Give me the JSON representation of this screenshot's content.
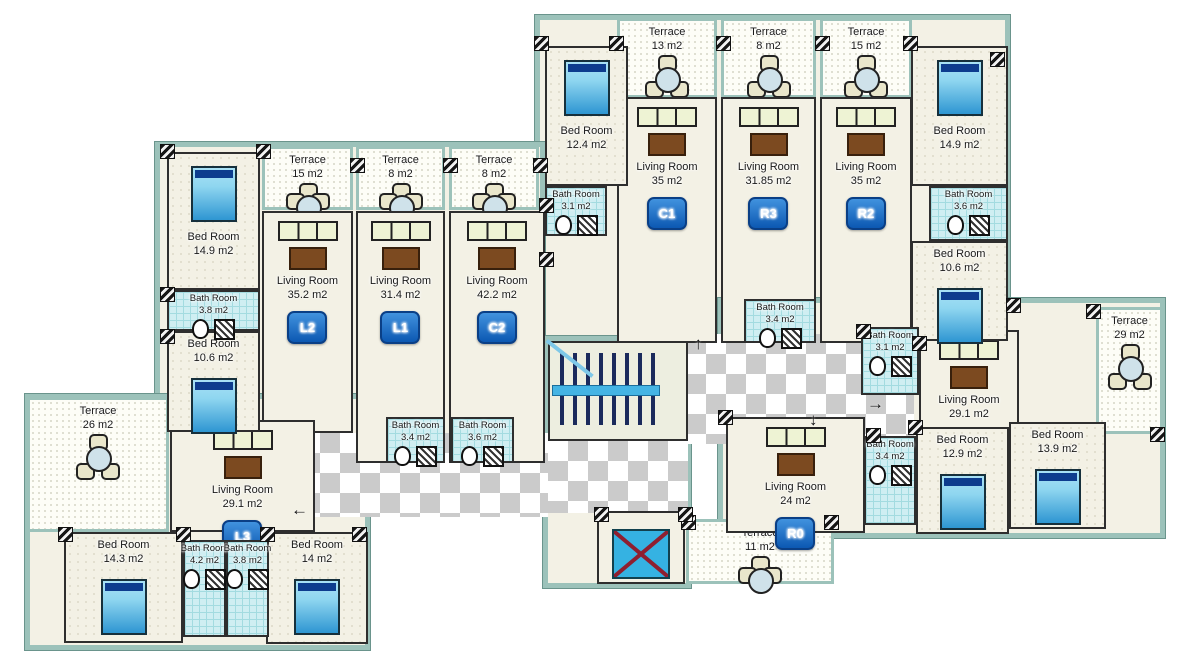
{
  "plan": {
    "colors": {
      "wall_teal": "#9cc2ba",
      "floor_cream": "#f3f1e5",
      "bath_cyan": "#cfeef2",
      "bed_blue": "#2e96d2",
      "badge_blue": "#0c58b2",
      "corridor_checker_gray": "#cbcbcb",
      "elevator_blue": "#35b2e2",
      "elevator_cross_red": "#8e1f30",
      "stairs_navy": "#1b2a5c"
    },
    "shells": [
      {
        "x": 535,
        "y": 15,
        "w": 475,
        "h": 330
      },
      {
        "x": 155,
        "y": 142,
        "w": 390,
        "h": 322
      },
      {
        "x": 25,
        "y": 394,
        "w": 345,
        "h": 256
      },
      {
        "x": 718,
        "y": 298,
        "w": 447,
        "h": 240
      },
      {
        "x": 543,
        "y": 336,
        "w": 148,
        "h": 252
      }
    ],
    "corridors": [
      {
        "x": 300,
        "y": 433,
        "w": 248,
        "h": 84
      },
      {
        "x": 666,
        "y": 334,
        "w": 248,
        "h": 110
      },
      {
        "x": 548,
        "y": 441,
        "w": 140,
        "h": 72
      }
    ],
    "rooms": [
      {
        "type": "terrace",
        "label": "Terrace",
        "area": "13 m2",
        "x": 617,
        "y": 18,
        "w": 100,
        "h": 80
      },
      {
        "type": "terrace",
        "label": "Terrace",
        "area": "8 m2",
        "x": 721,
        "y": 18,
        "w": 95,
        "h": 80
      },
      {
        "type": "terrace",
        "label": "Terrace",
        "area": "15 m2",
        "x": 820,
        "y": 18,
        "w": 92,
        "h": 80
      },
      {
        "type": "terrace",
        "label": "Terrace",
        "area": "15 m2",
        "x": 262,
        "y": 146,
        "w": 91,
        "h": 64
      },
      {
        "type": "terrace",
        "label": "Terrace",
        "area": "8 m2",
        "x": 356,
        "y": 146,
        "w": 89,
        "h": 64
      },
      {
        "type": "terrace",
        "label": "Terrace",
        "area": "8 m2",
        "x": 449,
        "y": 146,
        "w": 90,
        "h": 64
      },
      {
        "type": "terrace",
        "label": "Terrace",
        "area": "26 m2",
        "x": 27,
        "y": 397,
        "w": 142,
        "h": 135
      },
      {
        "type": "terrace",
        "label": "Terrace",
        "area": "29 m2",
        "x": 1096,
        "y": 307,
        "w": 67,
        "h": 127
      },
      {
        "type": "terrace",
        "label": "Terrace",
        "area": "11 m2",
        "x": 686,
        "y": 519,
        "w": 148,
        "h": 65
      },
      {
        "type": "living",
        "label": "Living Room",
        "area": "35 m2",
        "badge": "C1",
        "x": 617,
        "y": 97,
        "w": 100,
        "h": 246
      },
      {
        "type": "living",
        "label": "Living Room",
        "area": "31.85 m2",
        "badge": "R3",
        "x": 721,
        "y": 97,
        "w": 95,
        "h": 246
      },
      {
        "type": "living",
        "label": "Living Room",
        "area": "35 m2",
        "badge": "R2",
        "x": 820,
        "y": 97,
        "w": 92,
        "h": 246
      },
      {
        "type": "living",
        "label": "Living Room",
        "area": "35.2 m2",
        "badge": "L2",
        "x": 262,
        "y": 211,
        "w": 91,
        "h": 222
      },
      {
        "type": "living",
        "label": "Living Room",
        "area": "31.4 m2",
        "badge": "L1",
        "x": 356,
        "y": 211,
        "w": 89,
        "h": 252
      },
      {
        "type": "living",
        "label": "Living Room",
        "area": "42.2 m2",
        "badge": "C2",
        "x": 449,
        "y": 211,
        "w": 96,
        "h": 252
      },
      {
        "type": "living",
        "label": "Living Room",
        "area": "29.1 m2",
        "badge": "L3",
        "x": 170,
        "y": 420,
        "w": 145,
        "h": 112
      },
      {
        "type": "living",
        "label": "Living Room",
        "area": "29.1 m2",
        "badge": "R1",
        "x": 919,
        "y": 330,
        "w": 100,
        "h": 112
      },
      {
        "type": "living",
        "label": "Living Room",
        "area": "24 m2",
        "badge": "R0",
        "x": 726,
        "y": 417,
        "w": 139,
        "h": 116
      },
      {
        "type": "bed",
        "label": "Bed Room",
        "area": "12.4 m2",
        "x": 545,
        "y": 46,
        "w": 83,
        "h": 140,
        "label_pos": "bottom"
      },
      {
        "type": "bed",
        "label": "Bed Room",
        "area": "14.9 m2",
        "x": 911,
        "y": 46,
        "w": 97,
        "h": 140,
        "label_pos": "bottom"
      },
      {
        "type": "bed",
        "label": "Bed Room",
        "area": "10.6 m2",
        "x": 911,
        "y": 241,
        "w": 97,
        "h": 100
      },
      {
        "type": "bed",
        "label": "Bed Room",
        "area": "14.9 m2",
        "x": 167,
        "y": 152,
        "w": 93,
        "h": 138,
        "label_pos": "bottom"
      },
      {
        "type": "bed",
        "label": "Bed Room",
        "area": "10.6 m2",
        "x": 167,
        "y": 331,
        "w": 93,
        "h": 101
      },
      {
        "type": "bed",
        "label": "Bed Room",
        "area": "14.3 m2",
        "x": 64,
        "y": 532,
        "w": 119,
        "h": 111
      },
      {
        "type": "bed",
        "label": "Bed Room",
        "area": "14 m2",
        "x": 266,
        "y": 532,
        "w": 102,
        "h": 112
      },
      {
        "type": "bed",
        "label": "Bed Room",
        "area": "12.9 m2",
        "x": 916,
        "y": 427,
        "w": 93,
        "h": 107
      },
      {
        "type": "bed",
        "label": "Bed Room",
        "area": "13.9 m2",
        "x": 1009,
        "y": 422,
        "w": 97,
        "h": 107
      },
      {
        "type": "bath",
        "label": "Bath Room",
        "area": "3.1 m2",
        "x": 545,
        "y": 186,
        "w": 62,
        "h": 50
      },
      {
        "type": "bath",
        "label": "Bath Room",
        "area": "3.6 m2",
        "x": 929,
        "y": 186,
        "w": 79,
        "h": 55
      },
      {
        "type": "bath",
        "label": "Bath Room",
        "area": "3.4 m2",
        "x": 744,
        "y": 299,
        "w": 72,
        "h": 44
      },
      {
        "type": "bath",
        "label": "Bath Room",
        "area": "3.8 m2",
        "x": 167,
        "y": 290,
        "w": 93,
        "h": 41
      },
      {
        "type": "bath",
        "label": "Bath Room",
        "area": "3.4 m2",
        "x": 386,
        "y": 417,
        "w": 59,
        "h": 46
      },
      {
        "type": "bath",
        "label": "Bath Room",
        "area": "3.6 m2",
        "x": 451,
        "y": 417,
        "w": 63,
        "h": 46
      },
      {
        "type": "bath",
        "label": "Bath Room",
        "area": "4.2 m2",
        "x": 183,
        "y": 540,
        "w": 43,
        "h": 97
      },
      {
        "type": "bath",
        "label": "Bath Room",
        "area": "3.8 m2",
        "x": 226,
        "y": 540,
        "w": 43,
        "h": 97
      },
      {
        "type": "bath",
        "label": "Bath Room",
        "area": "3.1 m2",
        "x": 861,
        "y": 327,
        "w": 58,
        "h": 68
      },
      {
        "type": "bath",
        "label": "Bath Room",
        "area": "3.4 m2",
        "x": 864,
        "y": 436,
        "w": 52,
        "h": 89
      },
      {
        "type": "stairs",
        "x": 548,
        "y": 341,
        "w": 140,
        "h": 100
      },
      {
        "type": "elevator",
        "x": 597,
        "y": 511,
        "w": 88,
        "h": 73
      }
    ],
    "hatches": [
      [
        534,
        36
      ],
      [
        609,
        36
      ],
      [
        716,
        36
      ],
      [
        815,
        36
      ],
      [
        903,
        36
      ],
      [
        990,
        52
      ],
      [
        539,
        198
      ],
      [
        539,
        252
      ],
      [
        160,
        144
      ],
      [
        256,
        144
      ],
      [
        350,
        158
      ],
      [
        443,
        158
      ],
      [
        533,
        158
      ],
      [
        160,
        287
      ],
      [
        160,
        329
      ],
      [
        58,
        527
      ],
      [
        176,
        527
      ],
      [
        260,
        527
      ],
      [
        352,
        527
      ],
      [
        681,
        515
      ],
      [
        824,
        515
      ],
      [
        856,
        324
      ],
      [
        1006,
        298
      ],
      [
        1086,
        304
      ],
      [
        1150,
        427
      ],
      [
        908,
        420
      ],
      [
        718,
        410
      ],
      [
        866,
        428
      ],
      [
        912,
        336
      ],
      [
        594,
        507
      ],
      [
        678,
        507
      ]
    ],
    "arrows": [
      {
        "glyph": "←",
        "x": 291,
        "y": 500
      },
      {
        "glyph": "↑",
        "x": 694,
        "y": 334
      },
      {
        "glyph": "↓",
        "x": 809,
        "y": 410
      },
      {
        "glyph": "→",
        "x": 867,
        "y": 394
      }
    ]
  }
}
